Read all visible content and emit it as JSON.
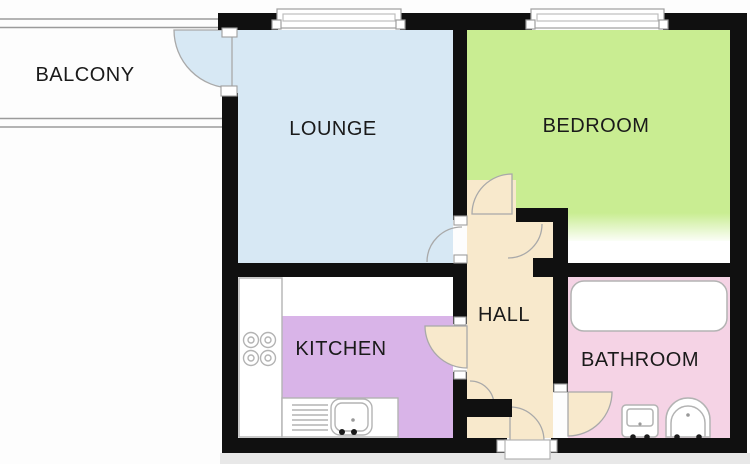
{
  "image_type": "apartment-floor-plan",
  "rooms": {
    "balcony": {
      "label": "BALCONY"
    },
    "lounge": {
      "label": "LOUNGE",
      "color": "#d7e8f4"
    },
    "bedroom": {
      "label": "BEDROOM",
      "color": "#c9ed92"
    },
    "kitchen": {
      "label": "KITCHEN",
      "color": "#d9b4e8"
    },
    "hall": {
      "label": "HALL",
      "color": "#f8e9cc"
    },
    "bathroom": {
      "label": "BATHROOM",
      "color": "#f5d3e5"
    }
  },
  "colors": {
    "wall": "#101010",
    "fixture_outline": "#b3b3b3",
    "window_outline": "#9e9e9e",
    "door_arc": "#a9a9a9",
    "rail": "#9b9b9b",
    "label_text": "#1a1a1a",
    "background": "#fdfdfd",
    "bottom_band": "#e8e8e8",
    "fixture_fill": "#ffffff"
  },
  "openings": [
    "balcony-door",
    "lounge-window",
    "bedroom-window",
    "lounge-door",
    "bedroom-door",
    "kitchen-door",
    "bathroom-door",
    "front-entrance-door"
  ],
  "fixtures": [
    "worktop",
    "hob-burners",
    "drainer",
    "kitchen-sink",
    "bathtub",
    "toilet",
    "wash-basin"
  ]
}
